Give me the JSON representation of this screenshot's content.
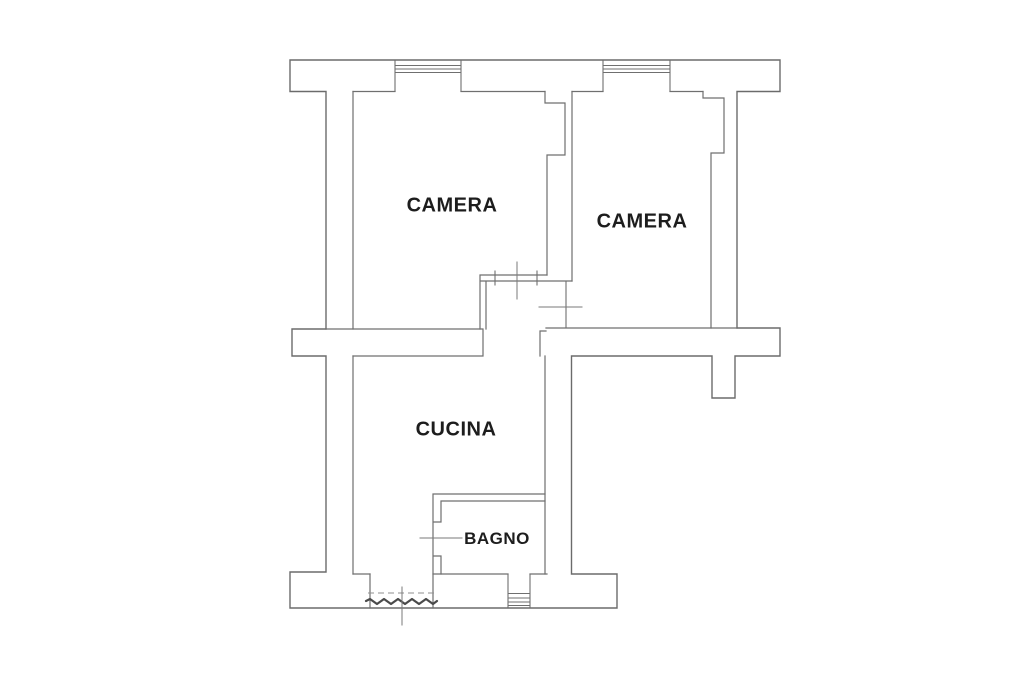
{
  "plan": {
    "type": "apartment-floor-plan",
    "rooms": {
      "camera1": {
        "label": "CAMERA"
      },
      "camera2": {
        "label": "CAMERA"
      },
      "cucina": {
        "label": "CUCINA"
      },
      "bagno": {
        "label": "BAGNO"
      }
    },
    "features": {
      "windows": [
        "window-top-left",
        "window-top-right",
        "window-bottom"
      ],
      "doors": [
        "balcony-door",
        "camera1-door",
        "camera2-door",
        "bagno-door"
      ],
      "section_marks": [
        "camera1-door-mark",
        "camera2-door-mark",
        "bagno-door-mark",
        "balcony-door-mark"
      ]
    }
  },
  "colors": {
    "background": "#ffffff",
    "wall_line": "#6b6b6b",
    "interior_line": "#6f6f6f",
    "section_line": "#7a7a7a",
    "dashed_line": "#8f8f8f",
    "threshold_line": "#4a4a4a",
    "text": "#1d1d1d"
  }
}
